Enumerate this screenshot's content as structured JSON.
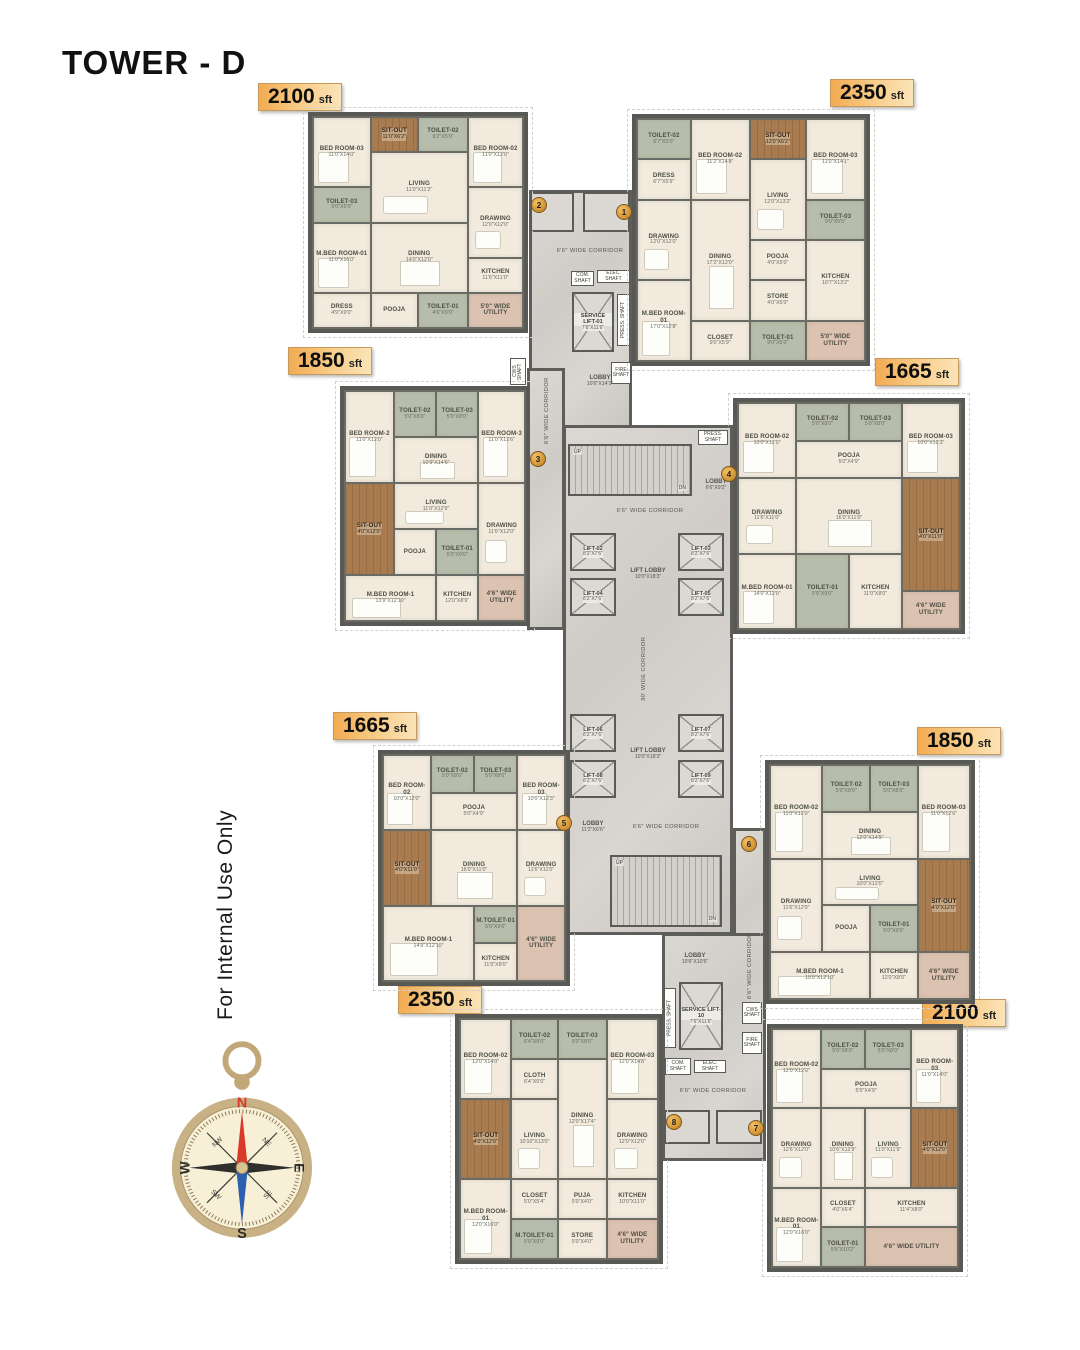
{
  "title": "TOWER - D",
  "watermark": "For Internal Use Only",
  "markers": [
    "1",
    "2",
    "3",
    "4",
    "5",
    "6",
    "7",
    "8"
  ],
  "units": [
    {
      "area_value": "2100",
      "area_unit": "sft",
      "rooms": [
        {
          "label": "BED ROOM-03",
          "dims": "11'0\"X14'0\""
        },
        {
          "label": "SIT-OUT",
          "dims": "11'0\"X6'2\""
        },
        {
          "label": "TOILET-02",
          "dims": "9'2\"X5'0\""
        },
        {
          "label": "BED ROOM-02",
          "dims": "11'0\"X12'0\""
        },
        {
          "label": "LIVING",
          "dims": "11'0\"X11'2\""
        },
        {
          "label": "TOILET-03",
          "dims": "9'0\"X5'0\""
        },
        {
          "label": "DRAWING",
          "dims": "12'0\"X12'0\""
        },
        {
          "label": "M.BED ROOM-01",
          "dims": "11'0\"X16'0\""
        },
        {
          "label": "DINING",
          "dims": "14'0\"X12'0\""
        },
        {
          "label": "KITCHEN",
          "dims": "11'6\"X11'0\""
        },
        {
          "label": "DRESS",
          "dims": "4'9\"X9'0\""
        },
        {
          "label": "POOJA",
          "dims": ""
        },
        {
          "label": "TOILET-01",
          "dims": "4'6\"X9'0\""
        },
        {
          "label": "5'0\" WIDE UTILITY",
          "dims": ""
        }
      ]
    },
    {
      "area_value": "2350",
      "area_unit": "sft",
      "rooms": [
        {
          "label": "TOILET-02",
          "dims": "6'7\"X5'0\""
        },
        {
          "label": "BED ROOM-02",
          "dims": "11'2\"X14'8\""
        },
        {
          "label": "SIT-OUT",
          "dims": "12'0\"X6'2\""
        },
        {
          "label": "BED ROOM-03",
          "dims": "11'0\"X14'1\""
        },
        {
          "label": "DRESS",
          "dims": "6'7\"X5'9\""
        },
        {
          "label": "LIVING",
          "dims": "12'0\"X13'2\""
        },
        {
          "label": "DRAWING",
          "dims": "12'0\"X12'0\""
        },
        {
          "label": "DINING",
          "dims": "17'2\"X12'0\""
        },
        {
          "label": "TOILET-03",
          "dims": "9'0\"X5'5\""
        },
        {
          "label": "POOJA",
          "dims": "4'0\"X5'0\""
        },
        {
          "label": "KITCHEN",
          "dims": "10'7\"X13'2\""
        },
        {
          "label": "M.BED ROOM-01",
          "dims": "17'0\"X12'8\""
        },
        {
          "label": "CLOSET",
          "dims": "9'0\"X5'9\""
        },
        {
          "label": "STORE",
          "dims": "4'0\"X5'0\""
        },
        {
          "label": "TOILET-01",
          "dims": "9'0\"X5'0\""
        },
        {
          "label": "5'0\" WIDE UTILITY",
          "dims": ""
        }
      ]
    },
    {
      "area_value": "1850",
      "area_unit": "sft",
      "rooms": [
        {
          "label": "BED ROOM-2",
          "dims": "11'0\"X12'0\""
        },
        {
          "label": "TOILET-02",
          "dims": "5'0\"X8'0\""
        },
        {
          "label": "TOILET-03",
          "dims": "5'0\"X8'0\""
        },
        {
          "label": "BED ROOM-3",
          "dims": "11'0\"X12'6\""
        },
        {
          "label": "DINING",
          "dims": "10'9\"X14'6\""
        },
        {
          "label": "SIT-OUT",
          "dims": "4'0\"X12'0\""
        },
        {
          "label": "LIVING",
          "dims": "11'0\"X12'9\""
        },
        {
          "label": "DRAWING",
          "dims": "11'6\"X12'0\""
        },
        {
          "label": "POOJA",
          "dims": ""
        },
        {
          "label": "TOILET-01",
          "dims": "5'0\"X9'0\""
        },
        {
          "label": "M.BED ROOM-1",
          "dims": "13'9\"X12'10\""
        },
        {
          "label": "KITCHEN",
          "dims": "12'0\"X8'9\""
        },
        {
          "label": "4'6\" WIDE UTILITY",
          "dims": ""
        }
      ]
    },
    {
      "area_value": "1665",
      "area_unit": "sft",
      "rooms": [
        {
          "label": "BED ROOM-02",
          "dims": "10'0\"X12'0\""
        },
        {
          "label": "TOILET-02",
          "dims": "5'0\"X8'0\""
        },
        {
          "label": "TOILET-03",
          "dims": "5'0\"X8'0\""
        },
        {
          "label": "BED ROOM-03",
          "dims": "10'0\"X12'3\""
        },
        {
          "label": "POOJA",
          "dims": "5'0\"X4'9\""
        },
        {
          "label": "DRAWING",
          "dims": "11'6\"X11'0\""
        },
        {
          "label": "DINING",
          "dims": "16'0\"X11'0\""
        },
        {
          "label": "SIT-OUT",
          "dims": "4'0\"X11'0\""
        },
        {
          "label": "M.BED ROOM-01",
          "dims": "14'0\"X12'0\""
        },
        {
          "label": "TOILET-01",
          "dims": "5'0\"X9'0\""
        },
        {
          "label": "KITCHEN",
          "dims": "11'0\"X8'0\""
        },
        {
          "label": "4'6\" WIDE UTILITY",
          "dims": ""
        }
      ]
    },
    {
      "area_value": "1665",
      "area_unit": "sft",
      "rooms": [
        {
          "label": "BED ROOM-02",
          "dims": "10'0\"X12'0\""
        },
        {
          "label": "TOILET-02",
          "dims": "5'0\"X8'0\""
        },
        {
          "label": "TOILET-03",
          "dims": "5'0\"X8'0\""
        },
        {
          "label": "BED ROOM-03",
          "dims": "10'0\"X12'3\""
        },
        {
          "label": "POOJA",
          "dims": "5'0\"X4'9\""
        },
        {
          "label": "SIT-OUT",
          "dims": "4'0\"X11'0\""
        },
        {
          "label": "DINING",
          "dims": "16'0\"X11'0\""
        },
        {
          "label": "DRAWING",
          "dims": "11'6\"X11'0\""
        },
        {
          "label": "M.BED ROOM-1",
          "dims": "14'9\"X12'10\""
        },
        {
          "label": "M.TOILET-01",
          "dims": "5'0\"X9'0\""
        },
        {
          "label": "KITCHEN",
          "dims": "11'0\"X8'0\""
        },
        {
          "label": "4'6\" WIDE UTILITY",
          "dims": ""
        }
      ]
    },
    {
      "area_value": "1850",
      "area_unit": "sft",
      "rooms": [
        {
          "label": "BED ROOM-02",
          "dims": "11'0\"X12'0\""
        },
        {
          "label": "TOILET-02",
          "dims": "5'0\"X8'0\""
        },
        {
          "label": "TOILET-03",
          "dims": "5'0\"X8'0\""
        },
        {
          "label": "BED ROOM-03",
          "dims": "11'0\"X12'6\""
        },
        {
          "label": "DINING",
          "dims": "12'0\"X14'9\""
        },
        {
          "label": "DRAWING",
          "dims": "11'6\"X12'0\""
        },
        {
          "label": "LIVING",
          "dims": "10'0\"X12'0\""
        },
        {
          "label": "SIT-OUT",
          "dims": "4'0\"X12'0\""
        },
        {
          "label": "POOJA",
          "dims": ""
        },
        {
          "label": "TOILET-01",
          "dims": "5'0\"X9'0\""
        },
        {
          "label": "M.BED ROOM-1",
          "dims": "15'0\"X12'10\""
        },
        {
          "label": "KITCHEN",
          "dims": "12'0\"X8'0\""
        },
        {
          "label": "4'6\" WIDE UTILITY",
          "dims": ""
        }
      ]
    },
    {
      "area_value": "2350",
      "area_unit": "sft",
      "rooms": [
        {
          "label": "BED ROOM-02",
          "dims": "12'0\"X14'0\""
        },
        {
          "label": "TOILET-02",
          "dims": "6'4\"X8'0\""
        },
        {
          "label": "CLOTH",
          "dims": "6'4\"X5'0\""
        },
        {
          "label": "TOILET-03",
          "dims": "5'0\"X8'0\""
        },
        {
          "label": "BED ROOM-03",
          "dims": "12'0\"X14'8\""
        },
        {
          "label": "SIT-OUT",
          "dims": "4'0\"X12'0\""
        },
        {
          "label": "LIVING",
          "dims": "10'10\"X13'0\""
        },
        {
          "label": "DINING",
          "dims": "12'0\"X17'4\""
        },
        {
          "label": "DRAWING",
          "dims": "12'0\"X12'0\""
        },
        {
          "label": "M.BED ROOM-01",
          "dims": "12'0\"X16'0\""
        },
        {
          "label": "CLOSET",
          "dims": "5'0\"X5'4\""
        },
        {
          "label": "M.TOILET-01",
          "dims": "5'0\"X9'0\""
        },
        {
          "label": "PUJA",
          "dims": "5'0\"X4'0\""
        },
        {
          "label": "STORE",
          "dims": "5'0\"X4'0\""
        },
        {
          "label": "KITCHEN",
          "dims": "10'0\"X11'0\""
        },
        {
          "label": "4'6\" WIDE UTILITY",
          "dims": ""
        }
      ]
    },
    {
      "area_value": "2100",
      "area_unit": "sft",
      "rooms": [
        {
          "label": "BED ROOM-02",
          "dims": "12'0\"X12'0\""
        },
        {
          "label": "TOILET-02",
          "dims": "5'0\"X8'0\""
        },
        {
          "label": "TOILET-03",
          "dims": "5'0\"X8'0\""
        },
        {
          "label": "POOJA",
          "dims": "5'0\"X4'9\""
        },
        {
          "label": "BED ROOM-03",
          "dims": "11'0\"X14'0\""
        },
        {
          "label": "DRAWING",
          "dims": "12'6\"X12'0\""
        },
        {
          "label": "DINING",
          "dims": "10'6\"X12'9\""
        },
        {
          "label": "LIVING",
          "dims": "11'0\"X11'9\""
        },
        {
          "label": "SIT-OUT",
          "dims": "4'0\"X12'0\""
        },
        {
          "label": "M.BED ROOM-01",
          "dims": "12'0\"X16'0\""
        },
        {
          "label": "CLOSET",
          "dims": "4'0\"X6'4\""
        },
        {
          "label": "TOILET-01",
          "dims": "5'6\"X10'2\""
        },
        {
          "label": "KITCHEN",
          "dims": "11'4\"X8'0\""
        },
        {
          "label": "4'6\" WIDE UTILITY",
          "dims": ""
        }
      ]
    }
  ],
  "core": {
    "corridor_h": "6'6\" WIDE CORRIDOR",
    "corridor_v": "30' WIDE CORRIDOR",
    "lift_lobby": {
      "label": "LIFT LOBBY",
      "dims": "10'0\"X18'3\""
    },
    "service_lift_top": {
      "label": "SERVICE LIFT-01",
      "dims": "7'6\"X11'6\""
    },
    "service_lift_bottom": {
      "label": "SERVICE LIFT-10",
      "dims": "7'6\"X11'6\""
    },
    "lobby_top": {
      "label": "LOBBY",
      "dims": "10'6\"X14'1\""
    },
    "lobby_mid": {
      "label": "LOBBY",
      "dims": "6'6\"X9'2\""
    },
    "lobby_low": {
      "label": "LOBBY",
      "dims": "11'2\"X6'6\""
    },
    "lobby_bottom": {
      "label": "LOBBY",
      "dims": "10'6\"X10'5\""
    },
    "lifts": [
      {
        "label": "LIFT-02",
        "dims": "8'2\"X7'6\""
      },
      {
        "label": "LIFT-03",
        "dims": "8'2\"X7'6\""
      },
      {
        "label": "LIFT-04",
        "dims": "8'2\"X7'6\""
      },
      {
        "label": "LIFT-05",
        "dims": "8'2\"X7'6\""
      },
      {
        "label": "LIFT-06",
        "dims": "8'2\"X7'6\""
      },
      {
        "label": "LIFT-07",
        "dims": "8'2\"X7'6\""
      },
      {
        "label": "LIFT-08",
        "dims": "8'2\"X7'6\""
      },
      {
        "label": "LIFT-09",
        "dims": "8'2\"X7'6\""
      }
    ],
    "shafts": {
      "com": "COM. SHAFT",
      "elec": "ELEC. SHAFT",
      "press": "PRESS. SHAFT",
      "fire": "FIRE SHAFT",
      "cws": "CWS SHAFT"
    },
    "stairs": {
      "up": "UP",
      "dn": "DN"
    }
  },
  "compass": {
    "n": "N",
    "e": "E",
    "s": "S",
    "w": "W",
    "ne": "NE",
    "nw": "NW",
    "se": "SE",
    "sw": "SW"
  }
}
